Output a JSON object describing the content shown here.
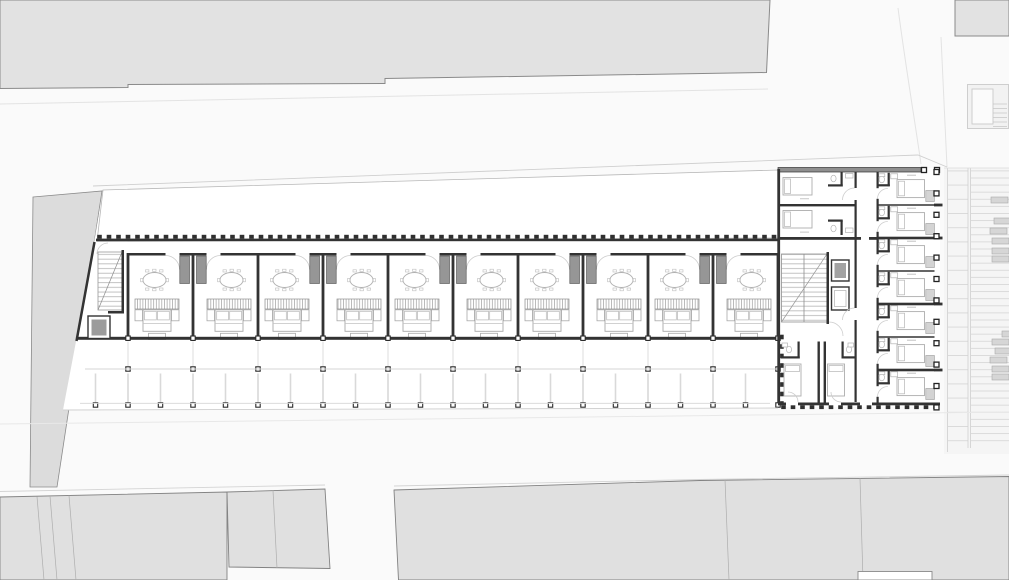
{
  "plan": {
    "meta": {
      "drawing_type": "architectural-floor-plan",
      "visible_text": ""
    },
    "canvas": {
      "w": 1009,
      "h": 580,
      "bg": "#fafafa",
      "paper": "#ffffff"
    },
    "colors": {
      "wall": "#333333",
      "wall_gray": "#8f8f8f",
      "neighbor_fill": "#e2e2e2",
      "neighbor_stroke": "#8a8a8a",
      "west_strip_fill": "#dcdcdc",
      "mass_fill": "#e0e0e0",
      "mass_stroke": "#828282",
      "furniture": "#a8a8a8",
      "furniture_light": "#bdbdbd",
      "door_arc": "#cccccc",
      "wardrobe_fill": "#969696",
      "elevator_fill": "#a2a2a2",
      "planter_fill": "#d6d6d6",
      "planter_stroke": "#a9a9a9",
      "grid_light": "#d6d6d6",
      "street_line": "#e6e6e6",
      "parcel_line": "#adadad",
      "column_stroke": "#2a2a2a"
    },
    "main_block": {
      "room_count": 10,
      "pair_count": 5,
      "first_wall_x": 128,
      "room_pitch": 65,
      "top_wall_y": 253,
      "room_height": 88,
      "bottom_wall_y": 336.8
    },
    "gallery": {
      "mid_row_y": 369,
      "mid_count": 11,
      "outer_row_y": 403.3,
      "outer_start_x": 95.5,
      "outer_pitch": 32.5,
      "outer_count": 22,
      "post_top_y": 373.5,
      "post_bottom_y": 403,
      "cont_top_y": 341.5,
      "cont_bottom_y": 369
    },
    "right_wing": {
      "east_room_x": 877,
      "east_room_top": 172,
      "east_room_pitch": 33,
      "east_room_count": 7,
      "corridor_wall_x": 876.5,
      "divider_len": 57.5,
      "column_line_x": 936.5,
      "column_count": 12,
      "column_pitch": 21.4,
      "column_top": 169.5,
      "wall_stub_ys": [
        205,
        238,
        304,
        370
      ]
    },
    "garden": {
      "planter_w": 17,
      "planter_h": 6,
      "planters": [
        [
          991,
          197
        ],
        [
          994,
          218
        ],
        [
          990,
          228
        ],
        [
          992,
          238
        ],
        [
          992,
          248
        ],
        [
          992,
          256
        ],
        [
          1002,
          331
        ],
        [
          992,
          339
        ],
        [
          995,
          348
        ],
        [
          990,
          357
        ],
        [
          992,
          366
        ],
        [
          992,
          374
        ]
      ]
    }
  }
}
